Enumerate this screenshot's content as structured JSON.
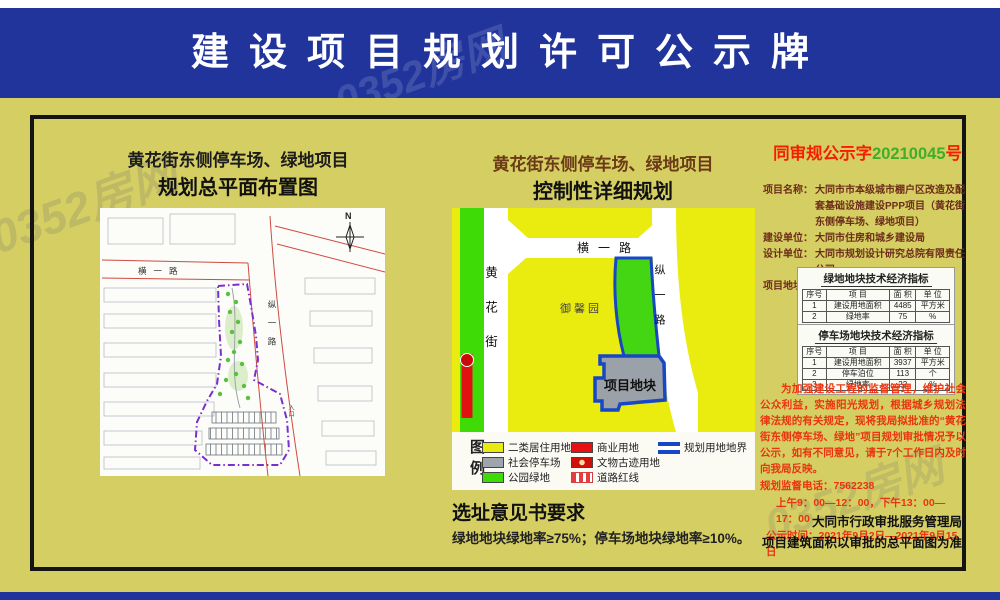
{
  "banner": {
    "title": "建设项目规划许可公示牌"
  },
  "watermark": {
    "text": "0352房网"
  },
  "left_panel": {
    "title": "黄花街东侧停车场、绿地项目",
    "subtitle": "规划总平面布置图",
    "map_labels": {
      "road_h": "横一路",
      "road_v": "纵一路",
      "north": "N",
      "entrance": "入口"
    }
  },
  "middle_panel": {
    "title": "黄花街东侧停车场、绿地项目",
    "subtitle": "控制性详细规划",
    "map_labels": {
      "road_top": "横一路",
      "street_left": "黄花街",
      "road_right": "纵一路",
      "estate": "御馨园",
      "site": "项目地块"
    },
    "legend": {
      "heading": "图例",
      "items": [
        {
          "swatch": "yellow",
          "label": "二类居住用地"
        },
        {
          "swatch": "gray",
          "label": "社会停车场"
        },
        {
          "swatch": "green",
          "label": "公园绿地"
        },
        {
          "swatch": "red",
          "label": "商业用地"
        },
        {
          "swatch": "relic",
          "label": "文物古迹用地"
        },
        {
          "swatch": "redline",
          "label": "道路红线"
        },
        {
          "swatch": "boundary",
          "label": "规划用地地界"
        }
      ]
    },
    "requirements_title": "选址意见书要求",
    "requirements_text": "绿地地块绿地率≥75%；停车场地块绿地率≥10%。"
  },
  "right_panel": {
    "notice_no_prefix": "同审规公示字",
    "notice_no_number": "20210045",
    "notice_no_suffix": "号",
    "info_lines": [
      {
        "label": "项目名称：",
        "value": "大同市市本级城市棚户区改造及配套基础设施建设PPP项目（黄花街东侧停车场、绿地项目）"
      },
      {
        "label": "建设单位：",
        "value": "大同市住房和城乡建设局"
      },
      {
        "label": "设计单位：",
        "value": "大同市规划设计研究总院有限责任公司"
      },
      {
        "label": "项目地址：",
        "value": "大同市黄花街东侧"
      }
    ],
    "tables": [
      {
        "title": "绿地地块技术经济指标",
        "headers": [
          "序号",
          "项 目",
          "面 积",
          "单 位"
        ],
        "rows": [
          [
            "1",
            "建设用地面积",
            "4485",
            "平方米"
          ],
          [
            "2",
            "绿地率",
            "75",
            "%"
          ]
        ]
      },
      {
        "title": "停车场地块技术经济指标",
        "headers": [
          "序号",
          "项 目",
          "面 积",
          "单 位"
        ],
        "rows": [
          [
            "1",
            "建设用地面积",
            "3937",
            "平方米"
          ],
          [
            "2",
            "停车泊位",
            "113",
            "个"
          ],
          [
            "3",
            "绿地率",
            "22",
            "%"
          ]
        ]
      }
    ],
    "notice_paragraph": "为加强建设工程的监督管理，维护社会公众利益，实施阳光规划，根据城乡规划法律法规的有关规定，现将我局拟批准的“黄花街东侧停车场、绿地”项目规划审批情况予以公示，如有不同意见，请于7个工作日内及时向我局反映。",
    "phone_line": "规划监督电话：7562238",
    "hours_line": "上午9：00—12：00，下午13：00—17：00",
    "period_line": "公示时间：2021年9月2日—2021年9月15日",
    "footer_lines": [
      "大同市行政审批服务管理局",
      "项目建筑面积以审批的总平面图为准"
    ]
  },
  "colors": {
    "banner_blue": "#20349b",
    "body_yellow": "#d5cf63",
    "map_yellow": "#eaec10",
    "park_green": "#3fdb06",
    "parking_gray": "#9fa5ac",
    "boundary_blue": "#1747c4",
    "commercial_red": "#e81010",
    "notice_red": "#f61e00",
    "notice_number_green": "#3fae29",
    "info_text_brown": "#6d2c1a"
  }
}
